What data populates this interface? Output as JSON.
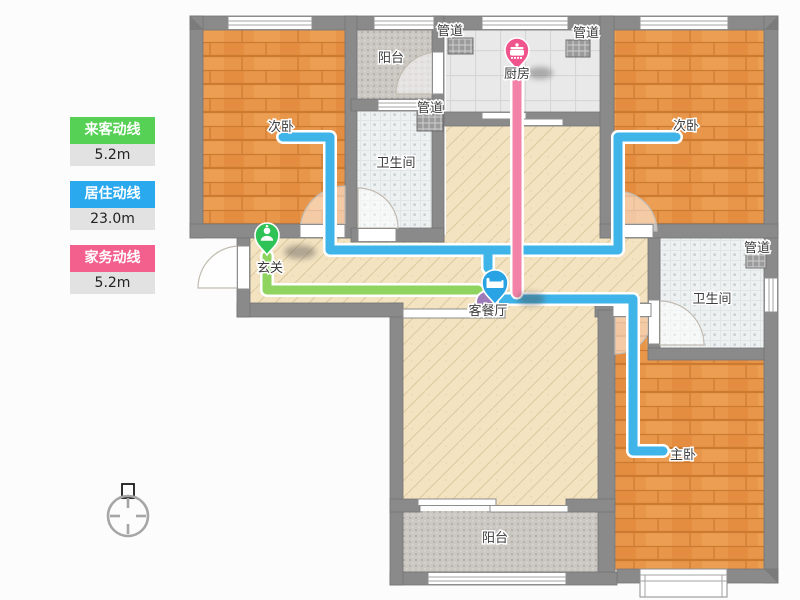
{
  "legend": {
    "items": [
      {
        "label": "来客动线",
        "value": "5.2m",
        "color": "#57d155"
      },
      {
        "label": "居住动线",
        "value": "23.0m",
        "color": "#2aa9ee"
      },
      {
        "label": "家务动线",
        "value": "5.2m",
        "color": "#f3608d"
      }
    ]
  },
  "rooms": {
    "bedroom_tl": "次卧",
    "bedroom_tr": "次卧",
    "master": "主卧",
    "kitchen": "厨房",
    "living": "客餐厅",
    "entry": "玄关",
    "bath_left": "卫生间",
    "bath_right": "卫生间",
    "balcony_top": "阳台",
    "balcony_bottom": "阳台",
    "duct_1": "管道",
    "duct_2": "管道",
    "duct_3": "管道",
    "duct_4": "管道"
  },
  "routes": {
    "visitor_color": "#8ed45e",
    "living_color": "#3fb4e8",
    "housework_color": "#f282a8"
  },
  "pins": {
    "entry_color": "#2ec257",
    "living_color": "#29a3e3",
    "kitchen_color": "#f0548c"
  }
}
